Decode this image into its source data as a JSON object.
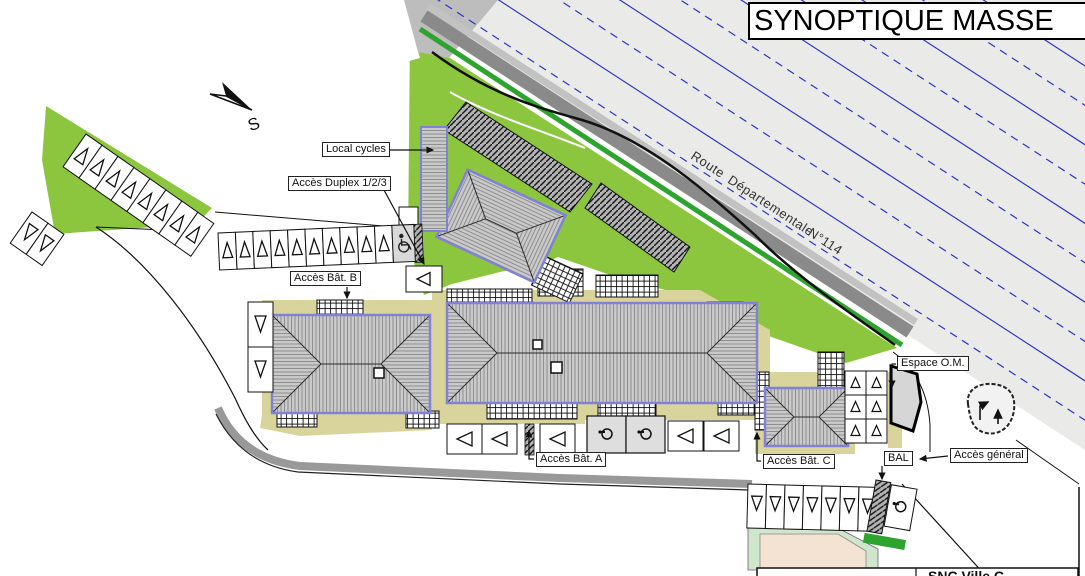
{
  "title": "SYNOPTIQUE MASSE",
  "compass": {
    "direction_label": "S"
  },
  "road": {
    "name_part1": "Route",
    "name_part2": "Départementale",
    "name_part3": "N°114"
  },
  "labels": {
    "local_cycles": "Local cycles",
    "acces_duplex": "Accès Duplex 1/2/3",
    "acces_bat_b": "Accès Bât. B",
    "acces_bat_a": "Accès Bât. A",
    "acces_bat_c": "Accès Bât. C",
    "espace_om": "Espace O.M.",
    "bal": "BAL",
    "acces_general": "Accès général"
  },
  "title_block": {
    "company_text": "SNC Ville C"
  },
  "icons": {
    "north_arrow": "north-dart",
    "wheelchair": "accessible-parking",
    "scooter": "two-wheeler-parking",
    "parking_marker_up": "△",
    "parking_marker_down": "▽",
    "parking_marker_left": "◁",
    "parking_marker_right": "▷"
  },
  "colors": {
    "grass": "#8cc63e",
    "road_surface": "#eaeae8",
    "road_line_blue": "#2b35c8",
    "road_dark_band": "#8a8a8a",
    "road_edge_green": "#2ea32e",
    "roof_gray": "#c9c9c9",
    "building_outline_blue": "#8181d5",
    "ground_beige": "#d9d49c",
    "mint_green": "#cfe6cd",
    "light_tan": "#f4e3d3"
  }
}
